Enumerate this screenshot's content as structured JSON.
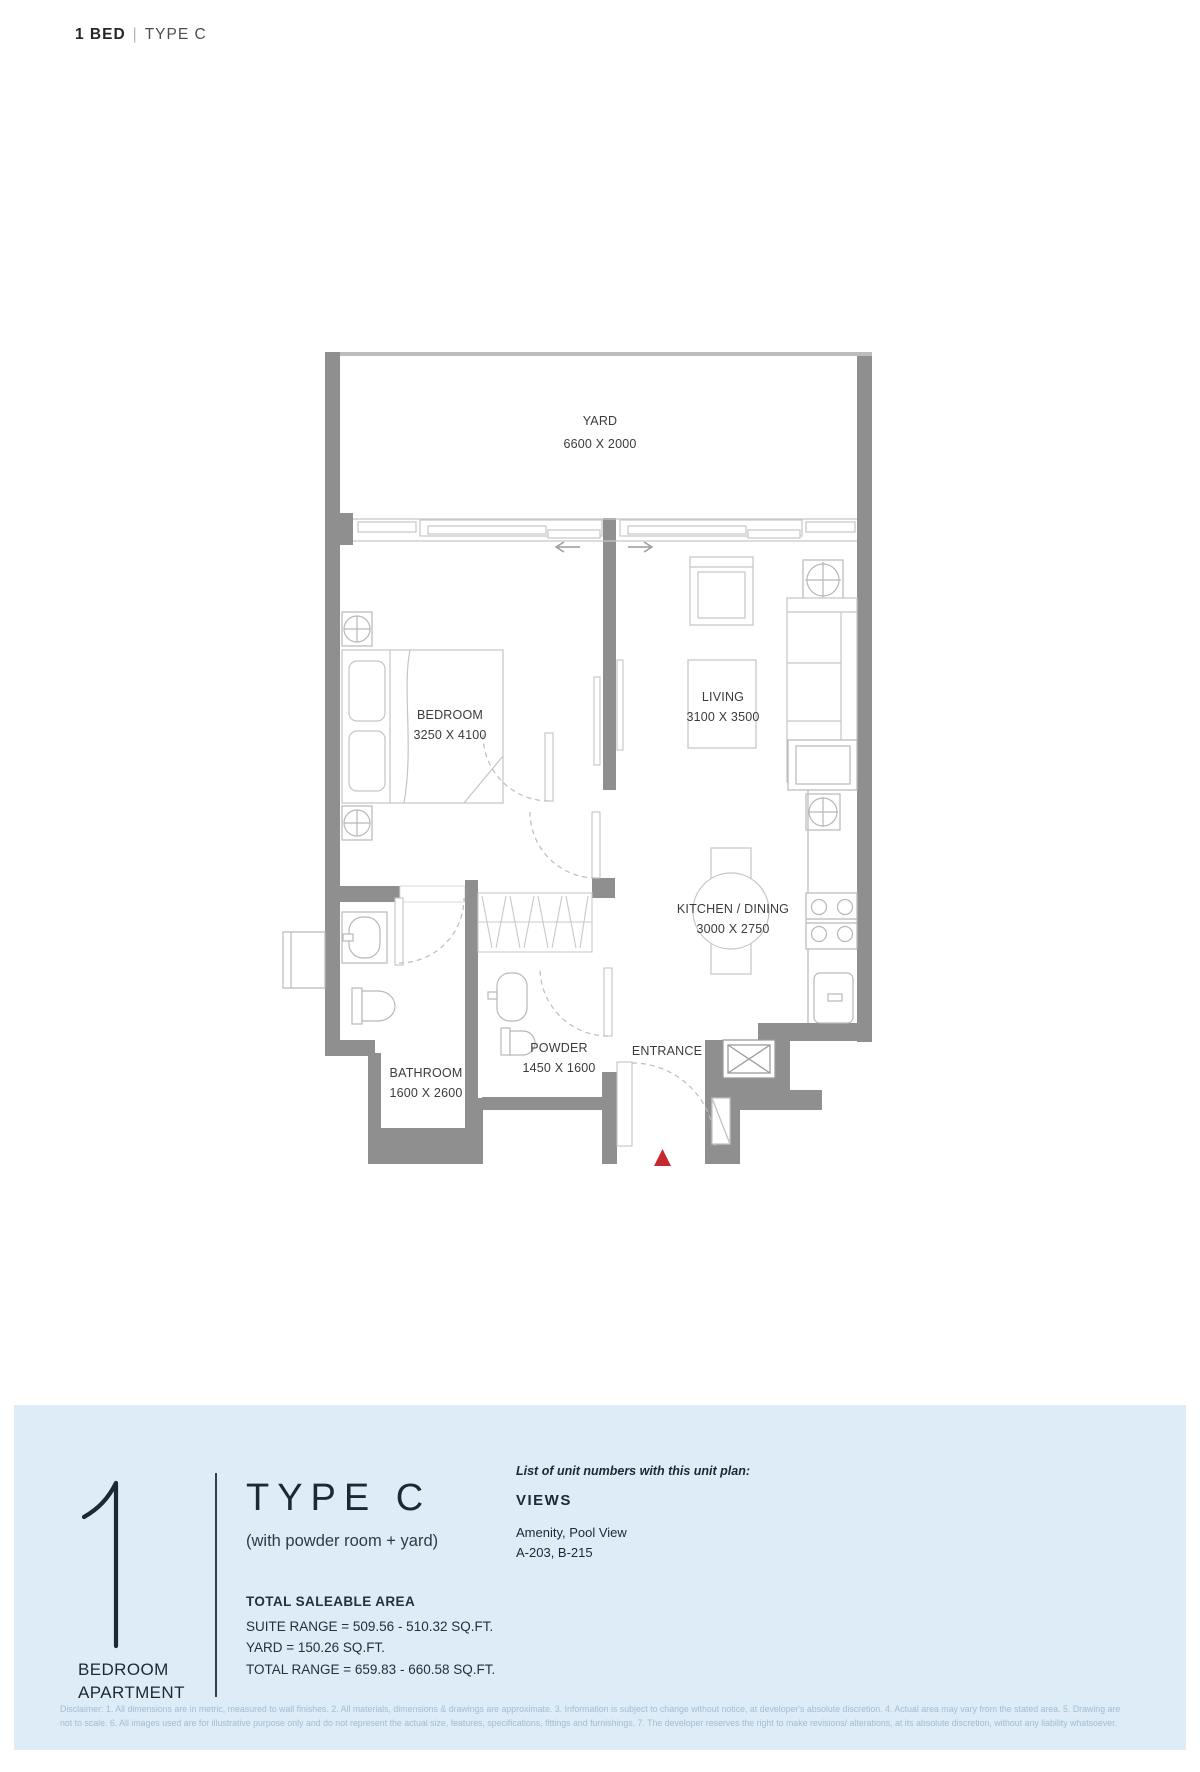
{
  "header": {
    "unit": "1 BED",
    "separator": "|",
    "plan_type": "TYPE C"
  },
  "plan": {
    "rooms": [
      {
        "name": "YARD",
        "dims": "6600 X 2000"
      },
      {
        "name": "BEDROOM",
        "dims": "3250 X 4100"
      },
      {
        "name": "LIVING",
        "dims": "3100 X 3500"
      },
      {
        "name": "KITCHEN / DINING",
        "dims": "3000 X 2750"
      },
      {
        "name": "BATHROOM",
        "dims": "1600 X 2600"
      },
      {
        "name": "POWDER",
        "dims": "1450 X 1600"
      },
      {
        "name": "ENTRANCE",
        "dims": ""
      }
    ]
  },
  "panel": {
    "big_number": "1",
    "big_label_line1": "BEDROOM",
    "big_label_line2": "APARTMENT",
    "type_title": "TYPE C",
    "type_subtitle": "(with powder room + yard)",
    "area_heading": "TOTAL SALEABLE AREA",
    "area_line1": "SUITE RANGE = 509.56 - 510.32 SQ.FT.",
    "area_line2": "YARD = 150.26 SQ.FT.",
    "area_line3": "TOTAL RANGE = 659.83 - 660.58 SQ.FT.",
    "units_intro": "List of unit numbers with this unit plan:",
    "views_heading": "VIEWS",
    "views_value": "Amenity, Pool View",
    "unit_numbers": "A-203, B-215"
  },
  "disclaimer": {
    "line1": "Disclaimer: 1. All dimensions are in metric, measured to wall finishes. 2. All materials, dimensions & drawings are approximate. 3. Information is subject to change without notice, at developer's absolute discretion. 4. Actual area may vary from the stated area. 5. Drawing are",
    "line2": "not to scale. 6. All images used are for illustrative purpose only and do not represent the actual size, features, specifications, fittings and furnishings. 7. The developer reserves the right to make revisions/ alterations, at its absolute discretion, without any liability whatsoever."
  },
  "colors": {
    "wall": "#8f8f8f",
    "thin_line": "#c6c6c6",
    "fixture_line": "#b8b8b8",
    "panel_bg": "#ddecf6",
    "panel_text": "#1c2933",
    "disclaimer_text": "#a3bdd1",
    "entrance_marker_red": "#c5292e",
    "plan_text": "#3c3c3c"
  }
}
